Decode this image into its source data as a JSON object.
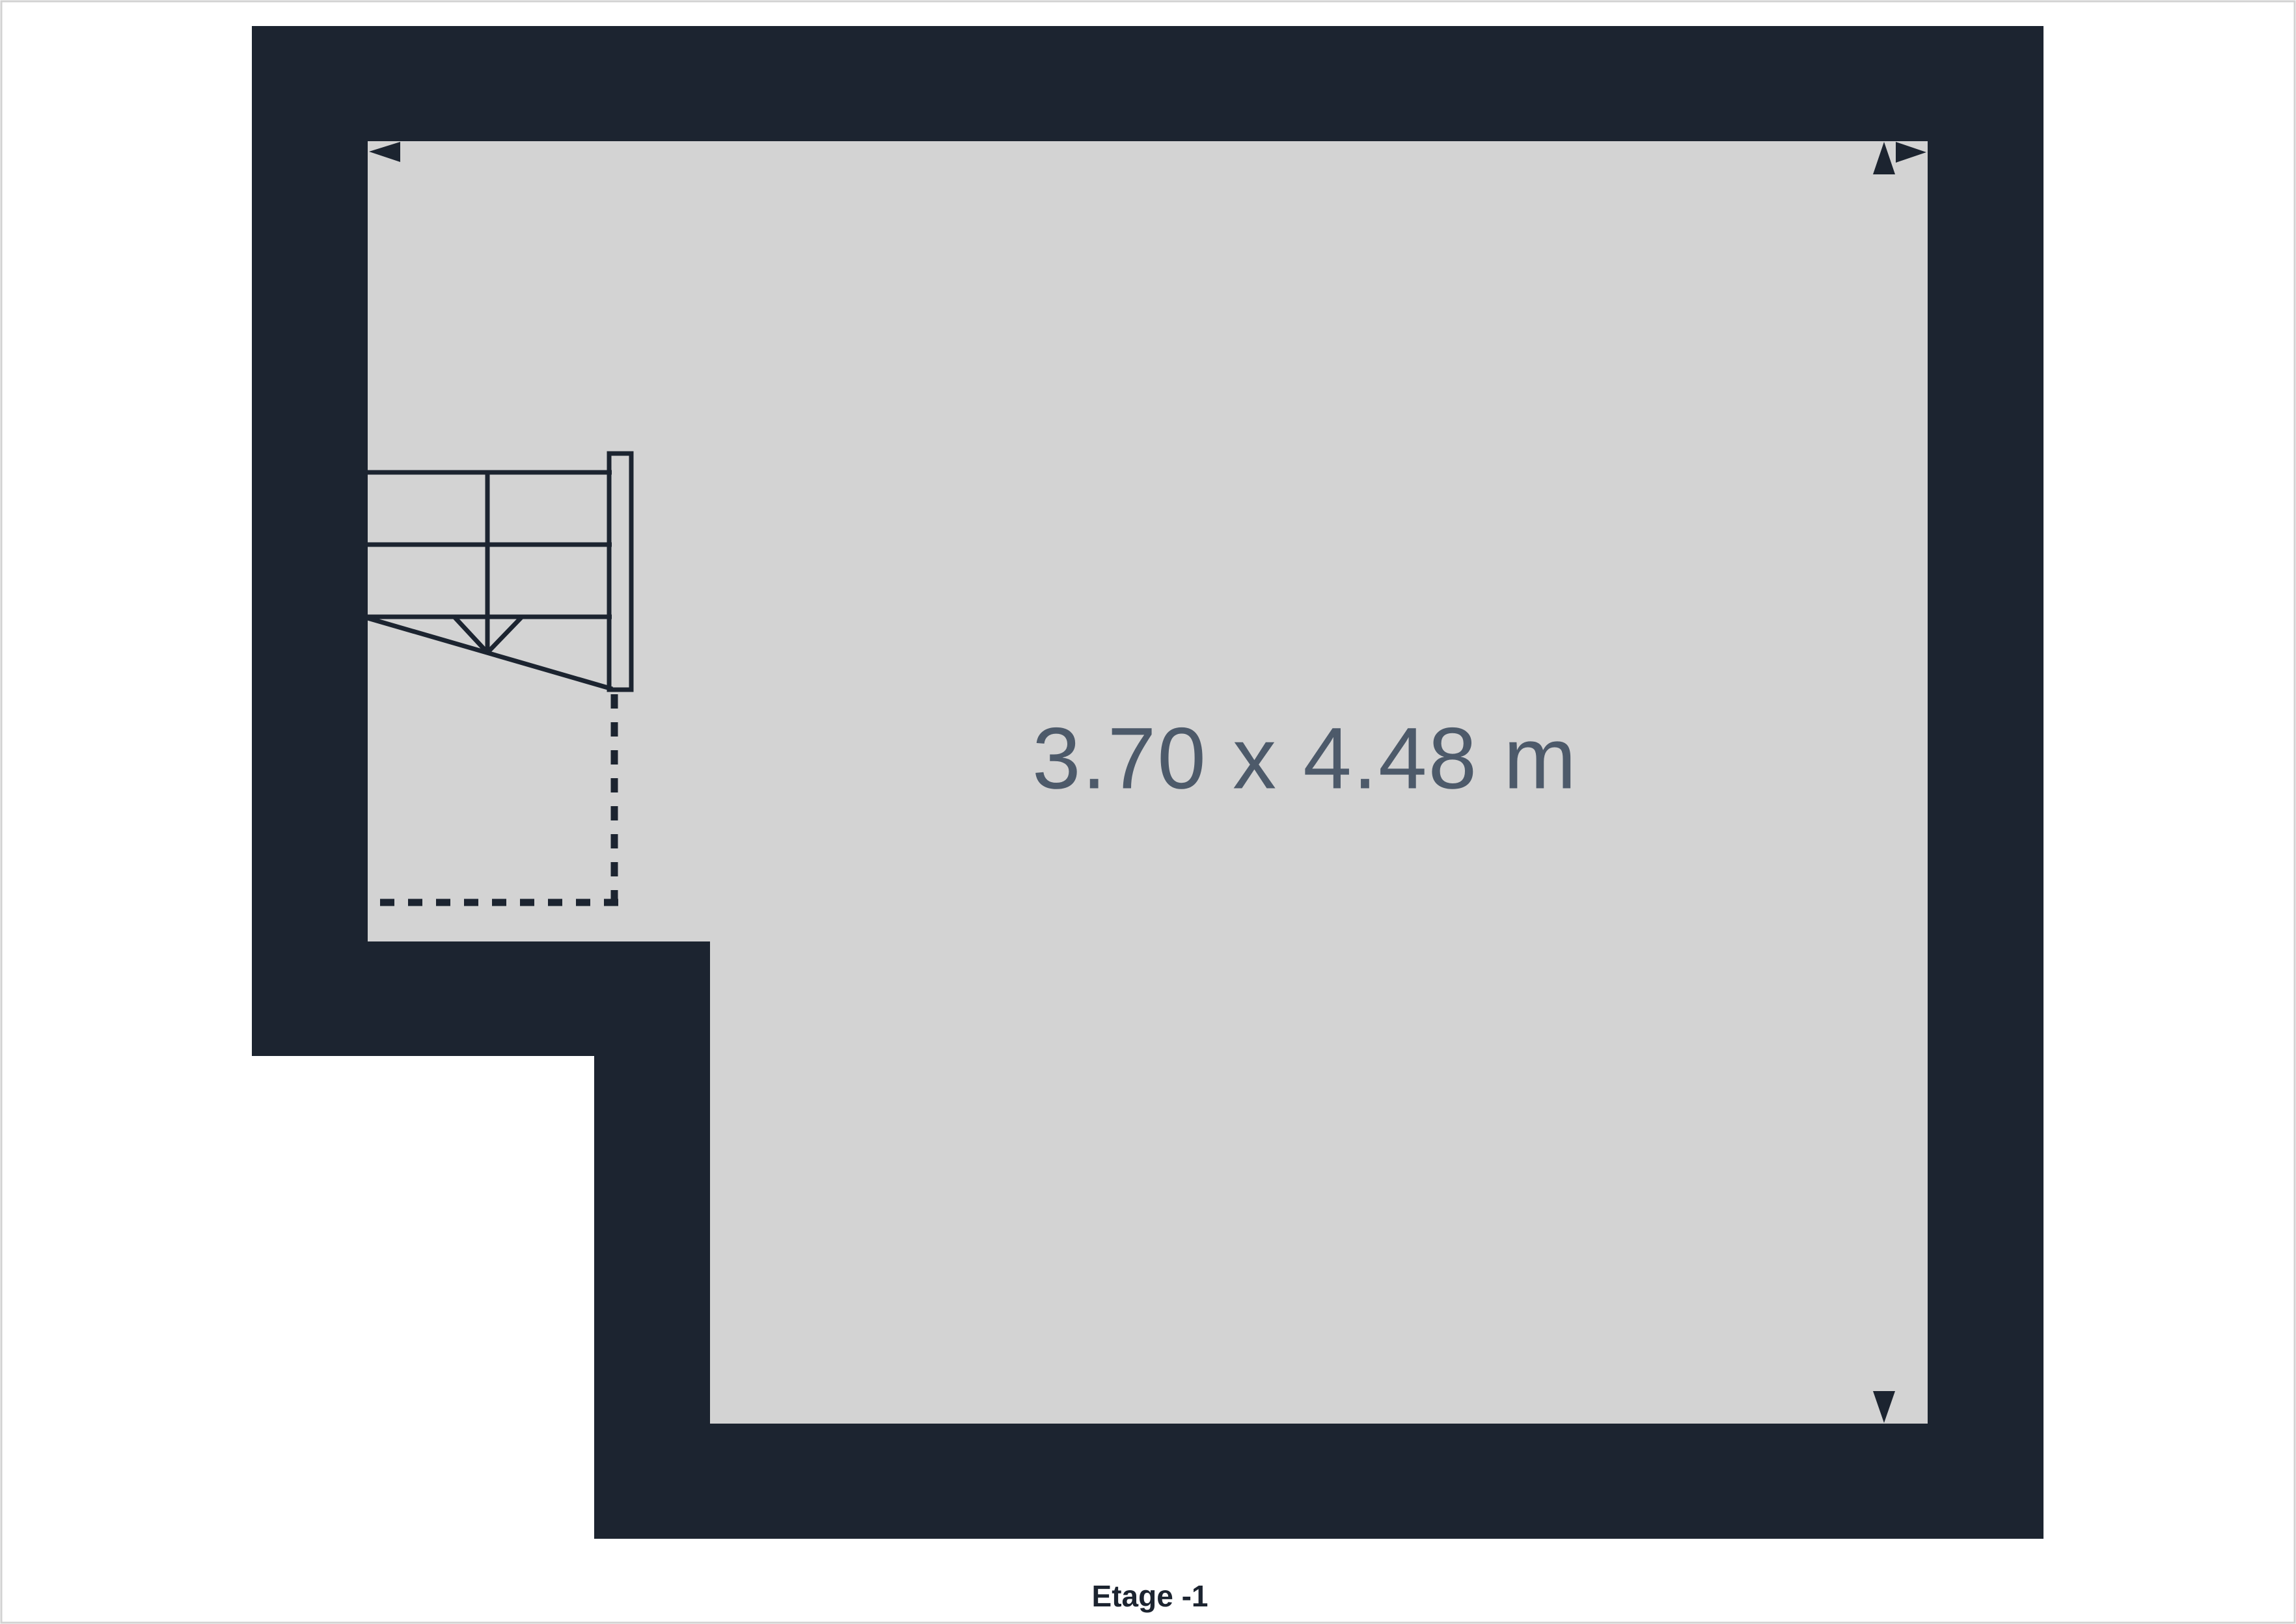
{
  "colors": {
    "background": "#FFFFFF",
    "page_border": "#D2D2D2",
    "wall": "#1C2430",
    "floor": "#D3D3D3",
    "dimension_text": "#4D5A6A"
  },
  "floor_plan": {
    "room": {
      "dimension_label": "3.70 x 4.48 m"
    },
    "floor_label": "Etage -1",
    "icons": [
      {
        "name": "dimension-arrow-left-icon"
      },
      {
        "name": "dimension-arrow-right-icon"
      },
      {
        "name": "dimension-arrow-up-icon"
      },
      {
        "name": "dimension-arrow-down-icon"
      },
      {
        "name": "staircase-symbol"
      }
    ]
  }
}
